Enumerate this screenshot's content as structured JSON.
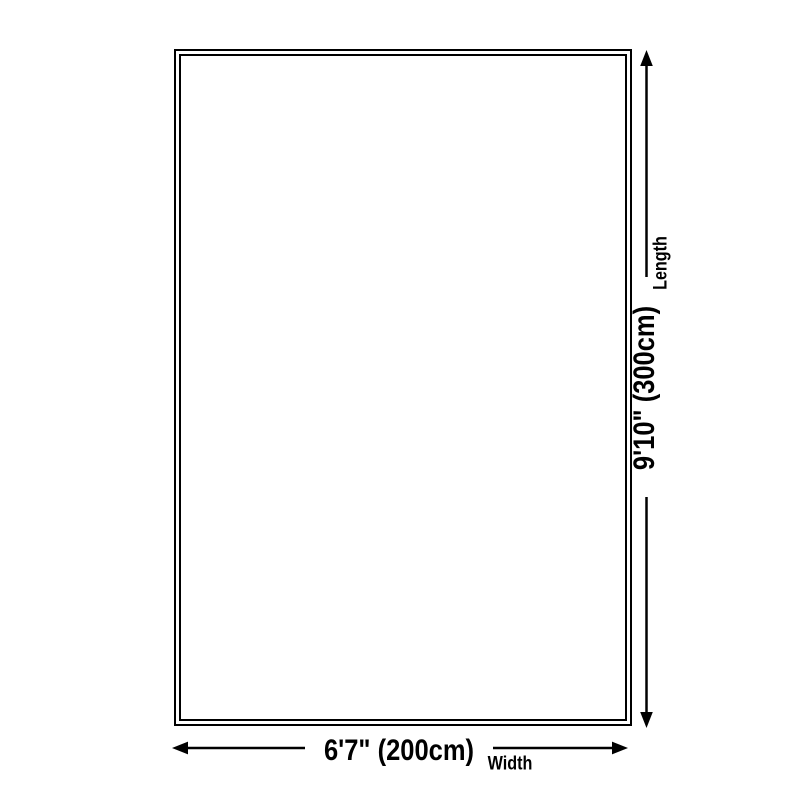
{
  "page": {
    "background_color": "#ffffff",
    "line_color": "#000000",
    "text_color": "#000000"
  },
  "diagram": {
    "kind": "product-size-diagram",
    "rug": {
      "shape": "rectangle",
      "border_style": "double-line"
    },
    "width_dimension": {
      "value": "6'7\" (200cm)",
      "label": "Width",
      "arrow": "double-headed-horizontal"
    },
    "length_dimension": {
      "value": "9'10\" (300cm)",
      "label": "Length",
      "arrow": "double-headed-vertical"
    }
  }
}
